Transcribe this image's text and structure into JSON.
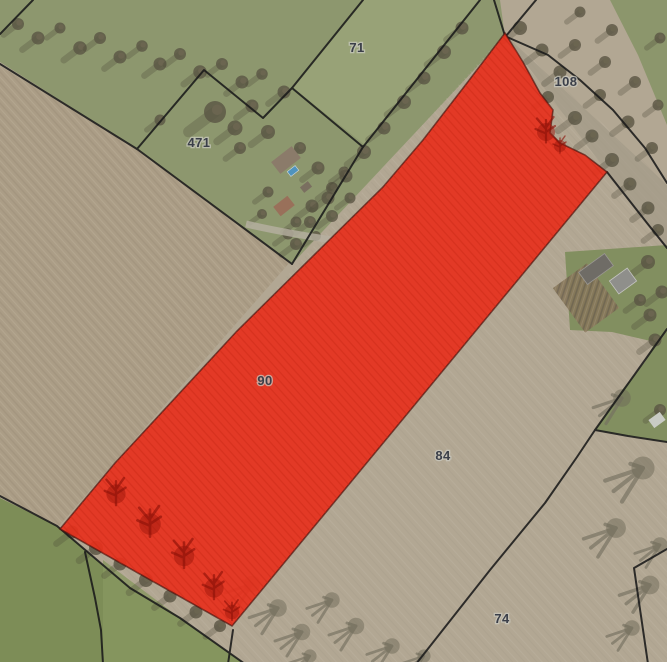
{
  "map": {
    "type": "aerial-cadastral-parcel-map",
    "parcel_labels": [
      {
        "number": "71"
      },
      {
        "number": "108"
      },
      {
        "number": "471"
      },
      {
        "number": "90"
      },
      {
        "number": "84"
      },
      {
        "number": "74"
      }
    ],
    "highlighted_parcel": {
      "number": "90",
      "state": "selected-highlighted-red"
    },
    "colors": {
      "highlight": "#e7301c",
      "boundary": "#1a1a1a",
      "label_text": "#3b3f49",
      "label_halo": "#ccccc2"
    }
  }
}
